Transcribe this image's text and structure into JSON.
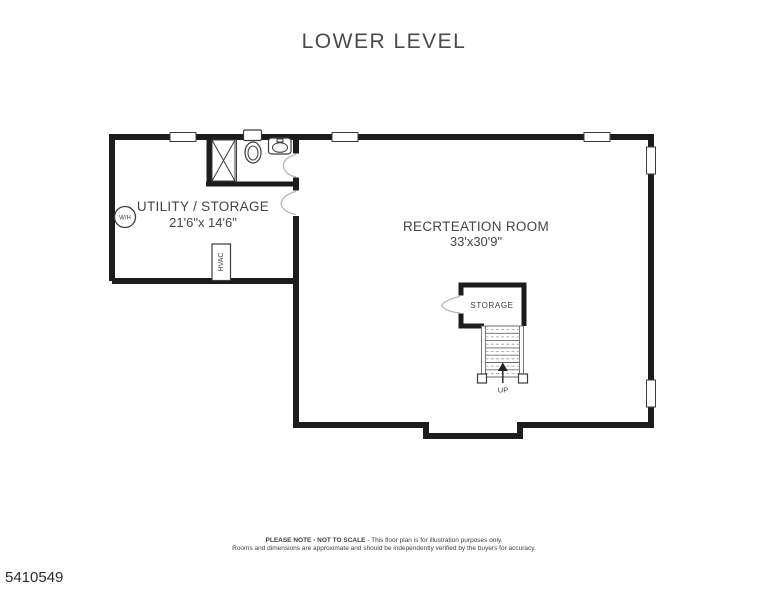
{
  "title": "LOWER LEVEL",
  "rooms": {
    "utility": {
      "name": "UTILITY / STORAGE",
      "dims": "21'6\"x 14'6\""
    },
    "recreation": {
      "name": "RECRTEATION ROOM",
      "dims": "33'x30'9\""
    },
    "storage_closet": {
      "name": "STORAGE"
    }
  },
  "labels": {
    "hvac": "HVAC",
    "water_heater": "W/H",
    "stairs_up": "UP"
  },
  "footer": {
    "note_bold": "PLEASE NOTE - NOT TO SCALE",
    "note_rest": " - This floor plan is for illustration purposes only.",
    "line2": "Rooms and dimensions are approximate and should be independently verified by the buyers for accuracy."
  },
  "listing_id": "5410549",
  "colors": {
    "wall": "#1c1c1c",
    "fixture_line": "#3c3c3c",
    "door_swing": "#b5b5b5",
    "text": "#454545"
  }
}
